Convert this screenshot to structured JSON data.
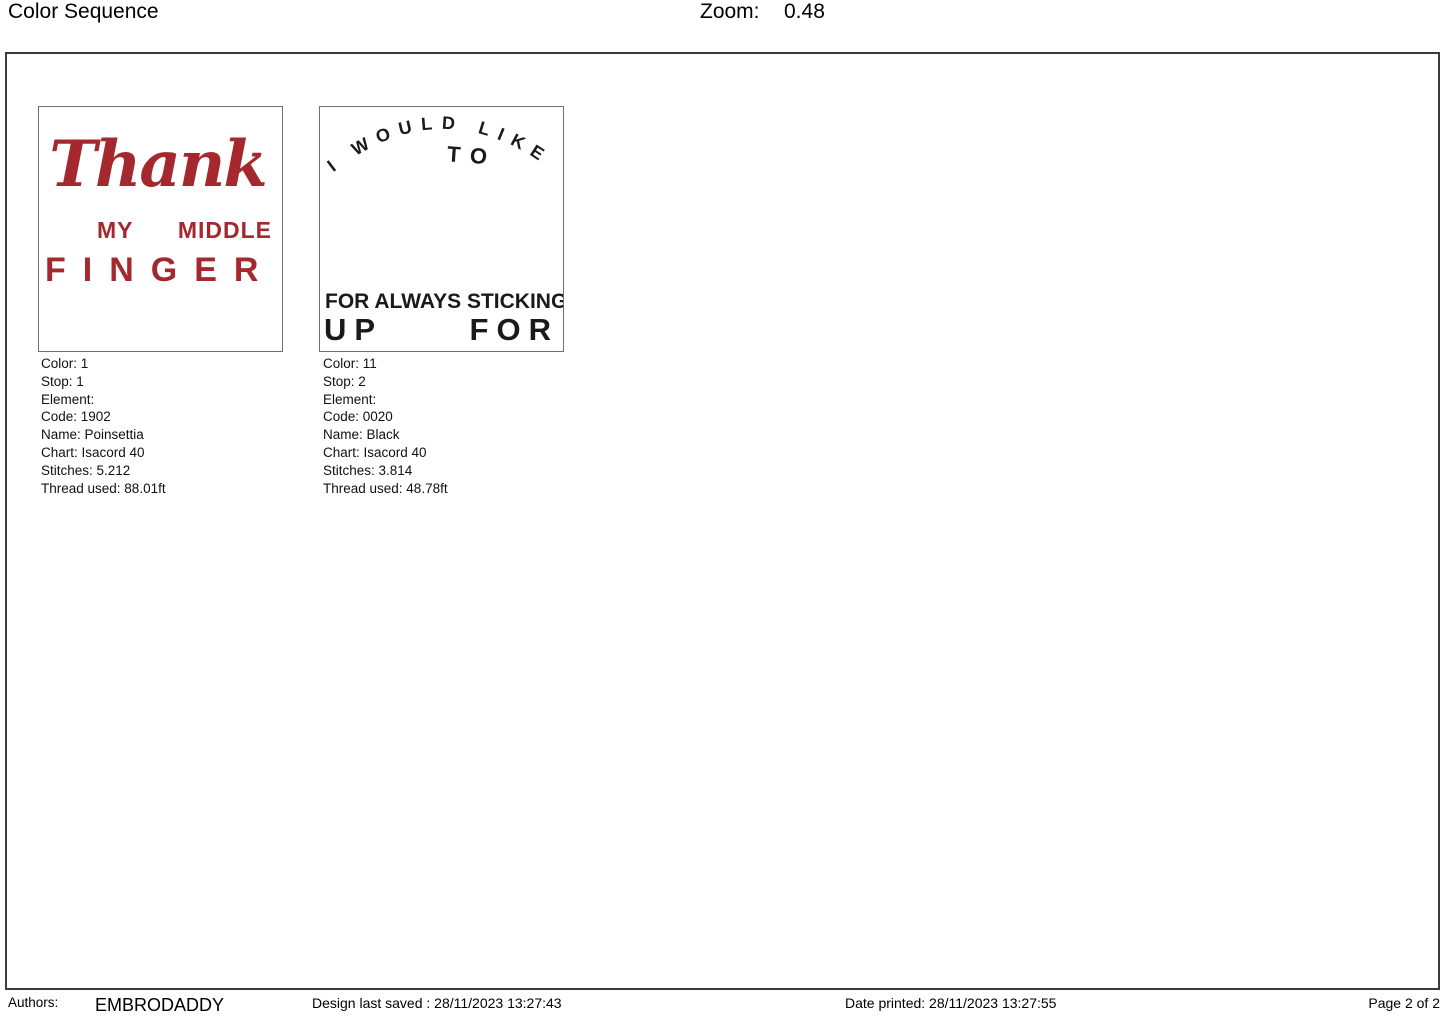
{
  "header": {
    "title": "Color Sequence",
    "zoom_label": "Zoom:",
    "zoom_value": "0.48"
  },
  "colors": {
    "thread_red": "#A5282E",
    "thread_black": "#1A1A1A",
    "sheet_border": "#3B3B3B",
    "card_border": "#707070"
  },
  "designs": [
    {
      "preview": {
        "script_word": "Thank",
        "line_2": "MY MIDDLE",
        "line_3": "FINGER",
        "color_hex": "#A5282E"
      },
      "details": [
        "Color: 1",
        "Stop: 1",
        "Element:",
        "Code: 1902",
        "Name: Poinsettia",
        "Chart: Isacord 40",
        "Stitches: 5.212",
        "Thread used: 88.01ft"
      ]
    },
    {
      "preview": {
        "arc_text": "I WOULD LIKE",
        "to_text": "TO",
        "bottom_line_1": "FOR ALWAYS STICKING",
        "bottom_line_2": "UP FOR ME",
        "color_hex": "#1A1A1A"
      },
      "details": [
        "Color: 11",
        "Stop: 2",
        "Element:",
        "Code: 0020",
        "Name: Black",
        "Chart: Isacord 40",
        "Stitches: 3.814",
        "Thread used: 48.78ft"
      ]
    }
  ],
  "footer": {
    "authors_label": "Authors:",
    "authors_value": "EMBRODADDY",
    "last_saved": "Design last saved : 28/11/2023 13:27:43",
    "date_printed": "Date printed: 28/11/2023 13:27:55",
    "page": "Page 2 of 2"
  }
}
